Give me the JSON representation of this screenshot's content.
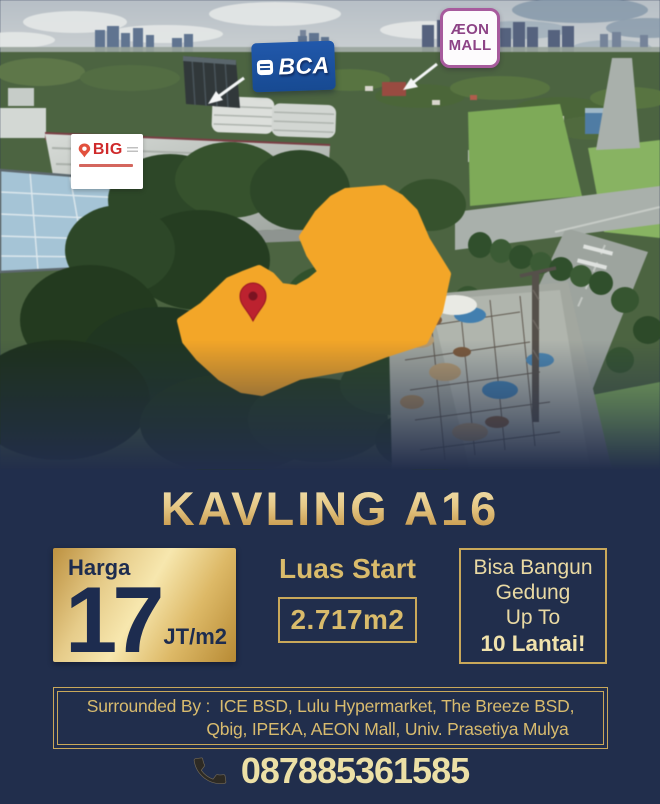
{
  "listing": {
    "title": "KAVLING A16",
    "price": {
      "label": "Harga",
      "value": "17",
      "unit": "JT/m2"
    },
    "area": {
      "label": "Luas Start",
      "value": "2.717m2"
    },
    "building": {
      "lines": [
        "Bisa Bangun",
        "Gedung",
        "Up To"
      ],
      "highlight": "10 Lantai!"
    },
    "surrounded": {
      "label": "Surrounded By :",
      "line1": "ICE BSD, Lulu Hypermarket, The Breeze BSD,",
      "line2": "Qbig, IPEKA, AEON Mall, Univ. Prasetiya Mulya"
    },
    "phone": "087885361585"
  },
  "photo": {
    "labels": {
      "bca": "BCA",
      "aeon_line1": "ÆON",
      "aeon_line2": "MALL",
      "qbig": "BIG"
    }
  },
  "colors": {
    "navy_background": "#212e4c",
    "gold_text": "#d9bb6b",
    "gold_border": "#c9a85a",
    "pale_gold": "#ece0a6",
    "plot_orange": "#f7a621",
    "pin_red": "#c2202e",
    "bca_blue": "#1c52a5",
    "aeon_purple": "#8d4386",
    "qbig_red": "#cf2a2b"
  }
}
